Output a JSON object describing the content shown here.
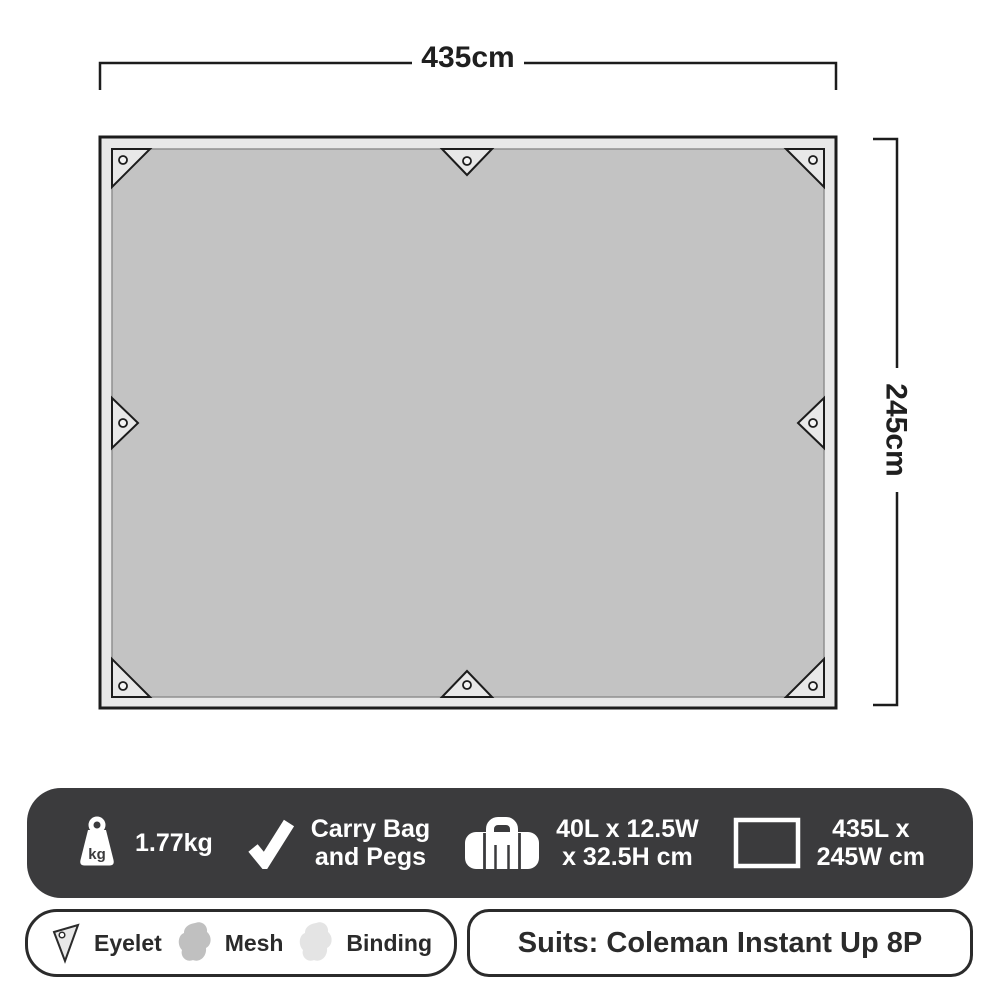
{
  "dimensions": {
    "width": "435cm",
    "height": "245cm"
  },
  "bar": {
    "weight": {
      "icon_label": "kg",
      "value": "1.77kg"
    },
    "included": {
      "line1": "Carry Bag",
      "line2": "and Pegs"
    },
    "packed_size": {
      "line1": "40L x 12.5W",
      "line2": "x 32.5H cm"
    },
    "flat_size": {
      "line1": "435L x",
      "line2": "245W cm"
    }
  },
  "legend": {
    "eyelet": "Eyelet",
    "mesh": "Mesh",
    "binding": "Binding"
  },
  "suits_label": "Suits: Coleman Instant Up 8P",
  "colors": {
    "mesh": "#c3c3c3",
    "binding": "#e8e8e8",
    "outline": "#1c1c1c",
    "bar_background": "#3b3b3d",
    "text_dark": "#2b2b2b"
  }
}
